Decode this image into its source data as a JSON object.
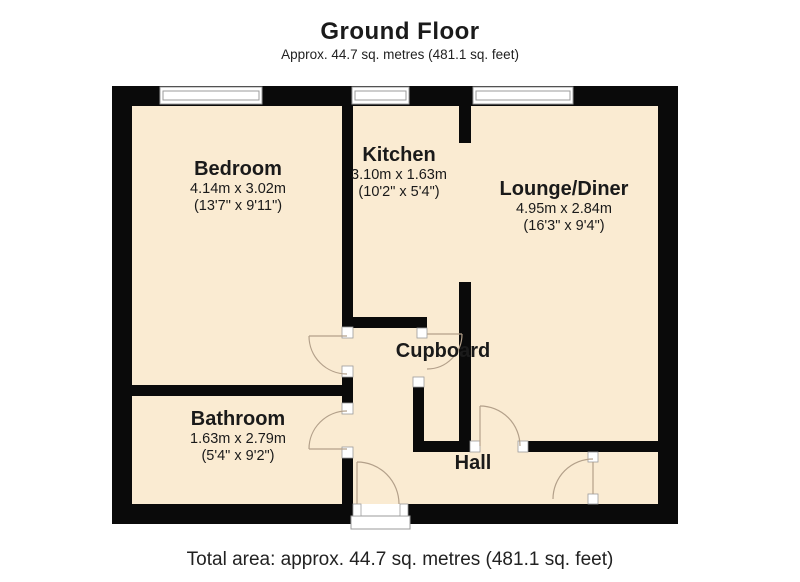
{
  "header": {
    "title": "Ground Floor",
    "subtitle": "Approx. 44.7 sq. metres (481.1 sq. feet)"
  },
  "rooms": {
    "bedroom": {
      "name": "Bedroom",
      "metric": "4.14m x 3.02m",
      "imperial": "(13'7\" x 9'11\")"
    },
    "kitchen": {
      "name": "Kitchen",
      "metric": "3.10m x 1.63m",
      "imperial": "(10'2\" x 5'4\")"
    },
    "lounge": {
      "name": "Lounge/Diner",
      "metric": "4.95m x 2.84m",
      "imperial": "(16'3\" x 9'4\")"
    },
    "cupboard": {
      "name": "Cupboard"
    },
    "bathroom": {
      "name": "Bathroom",
      "metric": "1.63m x 2.79m",
      "imperial": "(5'4\" x 9'2\")"
    },
    "hall": {
      "name": "Hall"
    }
  },
  "footer": {
    "total_area": "Total area: approx. 44.7 sq. metres (481.1 sq. feet)"
  },
  "colors": {
    "floor_fill": "#faebd2",
    "wall": "#0a0a0a",
    "door_swing": "#b3a08a",
    "window_frame": "#9b9b9b"
  }
}
